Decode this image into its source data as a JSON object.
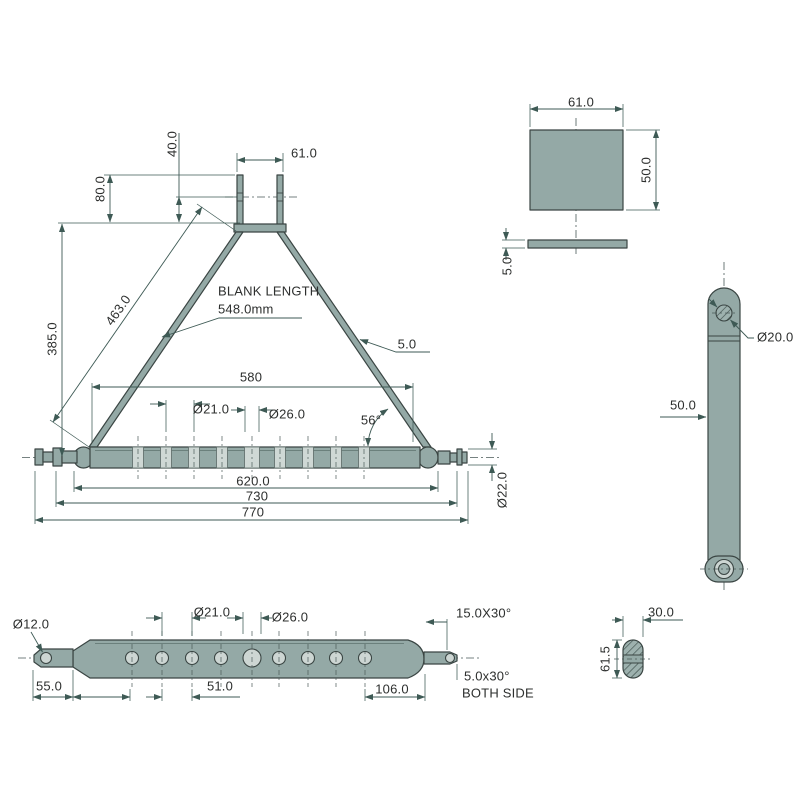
{
  "drawing": {
    "type": "technical-drawing",
    "part": "three-point linkage A-frame drawbar",
    "accent_color": "#94a9a6",
    "line_color": "#3e5a55"
  },
  "front": {
    "d40": "40.0",
    "d61": "61.0",
    "d80": "80.0",
    "d385": "385.0",
    "d463": "463.0",
    "blank_line1": "BLANK LENGTH",
    "blank_line2": "548.0mm",
    "thickness": "5.0",
    "d580": "580",
    "hole_small": "Ø21.0",
    "hole_large": "Ø26.0",
    "angle": "56°",
    "d620": "620.0",
    "d730": "730",
    "d770": "770",
    "pin_dia": "Ø22.0"
  },
  "plate": {
    "width": "61.0",
    "height": "50.0",
    "thickness": "5.0"
  },
  "arm": {
    "hole_dia": "Ø20.0",
    "width": "50.0"
  },
  "section": {
    "width": "30.0",
    "height": "61.5"
  },
  "bottom": {
    "pin_hole": "Ø12.0",
    "hole_small": "Ø21.0",
    "hole_large": "Ø26.0",
    "d55": "55.0",
    "d51": "51.0",
    "d106": "106.0",
    "chamfer_end": "15.0X30°",
    "chamfer_pin": "5.0x30°",
    "chamfer_note": "BOTH SIDE"
  }
}
